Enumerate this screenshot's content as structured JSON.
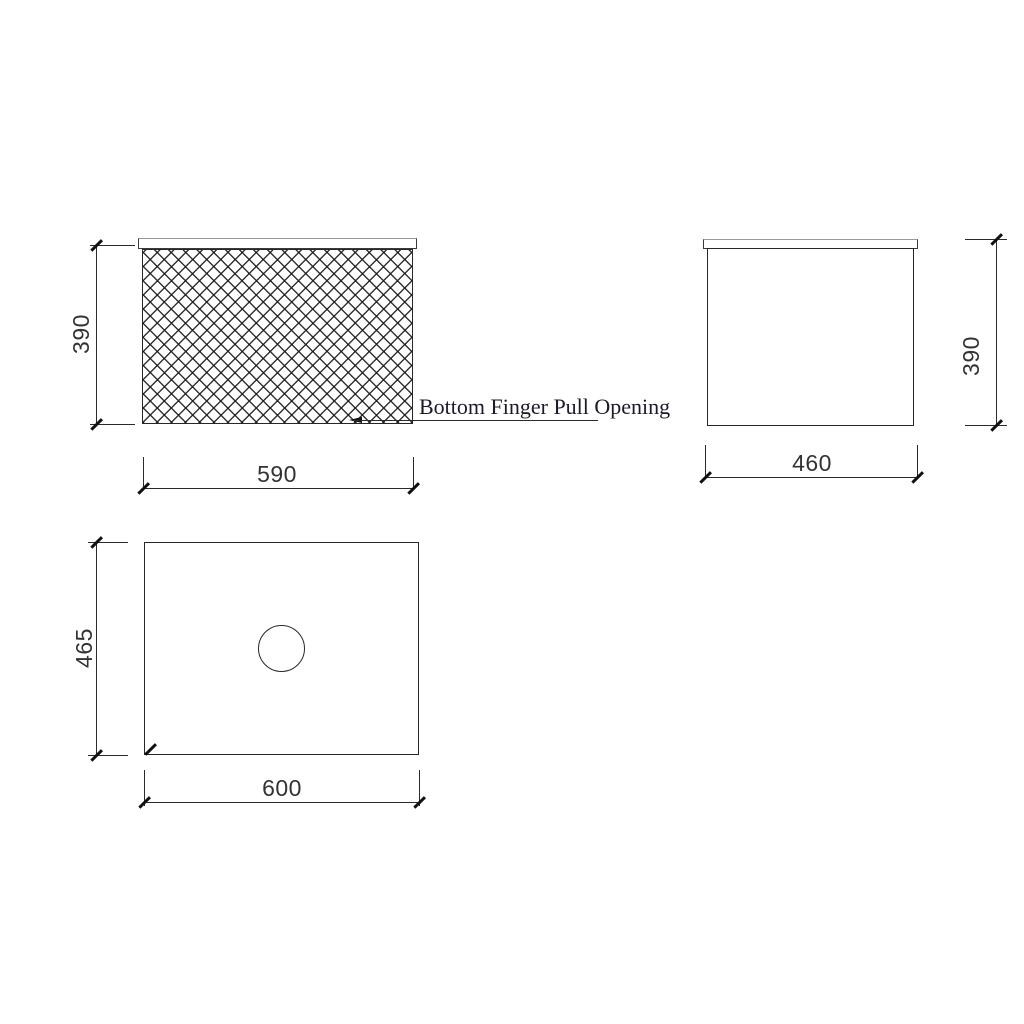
{
  "drawing": {
    "views": {
      "front": {
        "height_label": "390",
        "width_label": "590",
        "callout": "Bottom Finger Pull Opening"
      },
      "side": {
        "height_label": "390",
        "width_label": "460"
      },
      "top": {
        "height_label": "465",
        "width_label": "600"
      }
    },
    "colors": {
      "background": "#ffffff",
      "line": "#2b2b2b",
      "dimension_text": "#333333",
      "callout_text": "#1a1a2b"
    }
  }
}
